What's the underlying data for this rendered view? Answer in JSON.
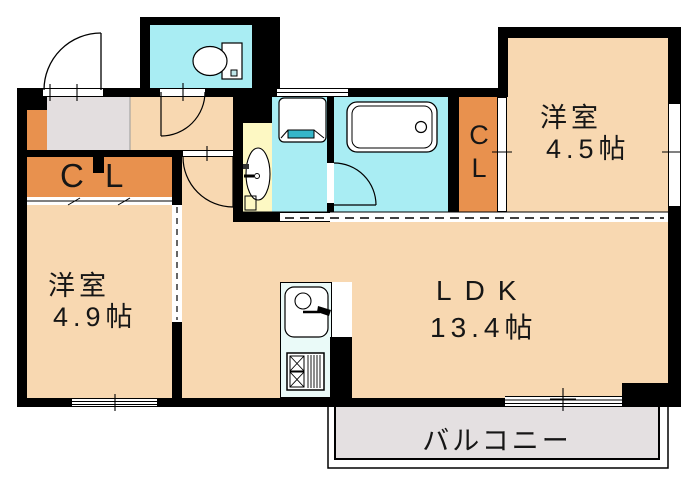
{
  "floorplan": {
    "rooms": {
      "western_room_right": {
        "name": "洋室",
        "size": "4.5帖"
      },
      "western_room_left": {
        "name": "洋室",
        "size": "4.9帖"
      },
      "ldk": {
        "name": "LDK",
        "size": "13.4帖"
      },
      "closet_left": {
        "label": "C L"
      },
      "closet_right": {
        "line1": "C",
        "line2": "L"
      },
      "balcony": {
        "label": "バルコニー"
      }
    },
    "fixtures": {
      "toilet": "toilet-icon",
      "bathtub": "bathtub-icon",
      "washbasin": "washbasin-icon",
      "washing_machine_pan": "washing-machine-pan-icon",
      "kitchen_sink": "kitchen-sink-icon",
      "stove": "stove-icon"
    },
    "colors": {
      "wall": "#000000",
      "room_peach": "#f8d8b1",
      "closet_orange": "#e8914e",
      "water_cyan": "#a9edf3",
      "basin_yellow": "#fdf8c3",
      "entry_gray": "#e3dedf",
      "balcony_gray": "#e4e0e1",
      "kitchen_pale": "#eafaf8",
      "pan_teal": "#35b6c9"
    }
  }
}
